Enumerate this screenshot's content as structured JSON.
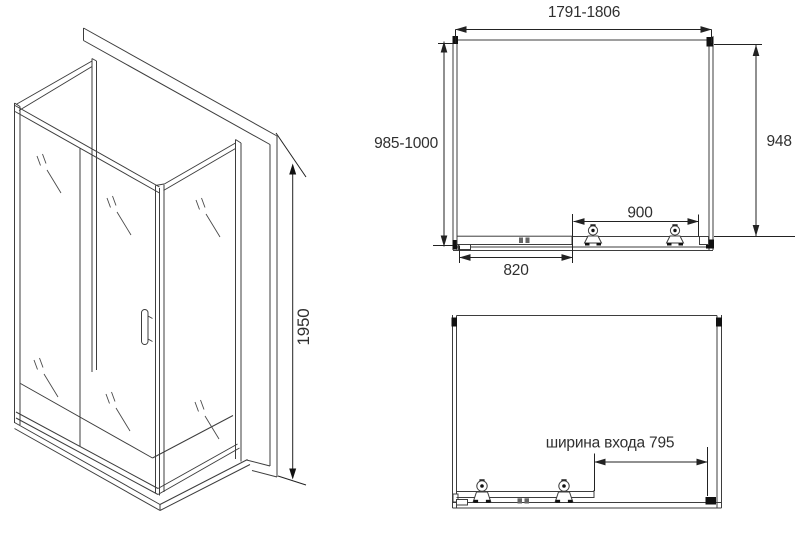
{
  "views": {
    "isometric": {
      "height_dim": "1950"
    },
    "top": {
      "width_dim": "1791-1806",
      "depth_dim": "985-1000",
      "side_dim": "948",
      "panel_dim": "900",
      "door_dim": "820"
    },
    "front": {
      "entrance_dim": "ширина входа 795"
    }
  },
  "colors": {
    "line": "#3d3d3d",
    "dimension": "#222222",
    "text": "#2f2f2f",
    "background": "#ffffff"
  }
}
